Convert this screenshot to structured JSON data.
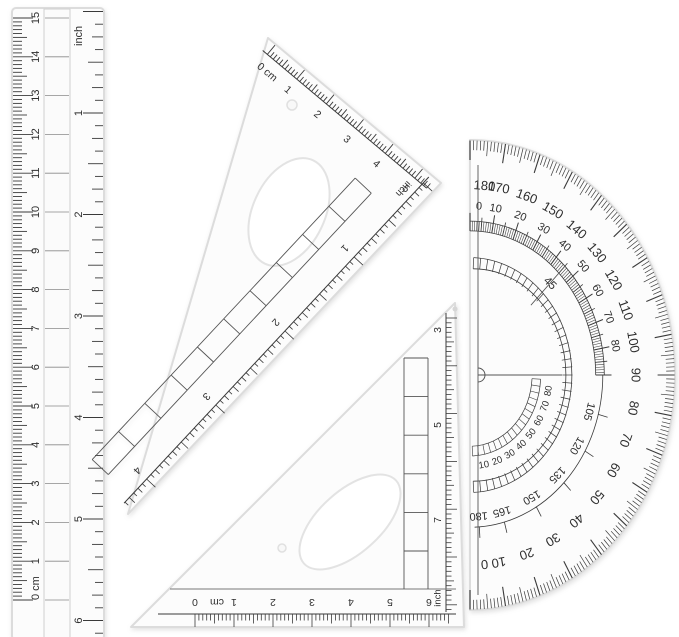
{
  "colors": {
    "background": "#ffffff",
    "ink": "#3a3a3a",
    "plastic_fill": "#fcfcfc",
    "plastic_edge": "#dcdcdc"
  },
  "ruler": {
    "cm_labels": [
      "0 cm",
      "1",
      "2",
      "3",
      "4",
      "5",
      "6",
      "7",
      "8",
      "9",
      "10",
      "11",
      "12",
      "13",
      "14",
      "15"
    ],
    "cm_unit": "cm",
    "inch_unit_label": "inch",
    "inch_labels": [
      "1",
      "2",
      "3",
      "4",
      "5",
      "6"
    ]
  },
  "triangle_large": {
    "cm_scale": {
      "labels": [
        "0 cm",
        "1",
        "2",
        "3",
        "4",
        "5"
      ],
      "unit": "cm"
    },
    "inch_scale": {
      "unit_label": "inch",
      "labels": [
        "1",
        "2",
        "3",
        "4"
      ]
    }
  },
  "triangle_small": {
    "edge_scale": {
      "labels": [
        "3",
        "5",
        "7"
      ],
      "unit_label": "inch"
    },
    "bottom_scale": {
      "zero_label": "0",
      "unit_label": "cm",
      "labels": [
        "0",
        "1",
        "2",
        "3",
        "4",
        "5",
        "6"
      ]
    }
  },
  "protractor": {
    "outer_labels": [
      180,
      170,
      160,
      150,
      140,
      130,
      120,
      110,
      100,
      90,
      80,
      70,
      60,
      50,
      40,
      30,
      20,
      10,
      0
    ],
    "inner_labels_upper": [
      0,
      10,
      20,
      30,
      40,
      50,
      60,
      70,
      80
    ],
    "diagonal_label": "45",
    "inner_labels_lower": [
      105,
      120,
      135,
      150,
      165,
      180
    ],
    "reversed_labels": [
      80,
      70,
      60,
      50,
      40,
      30,
      20,
      10
    ]
  }
}
